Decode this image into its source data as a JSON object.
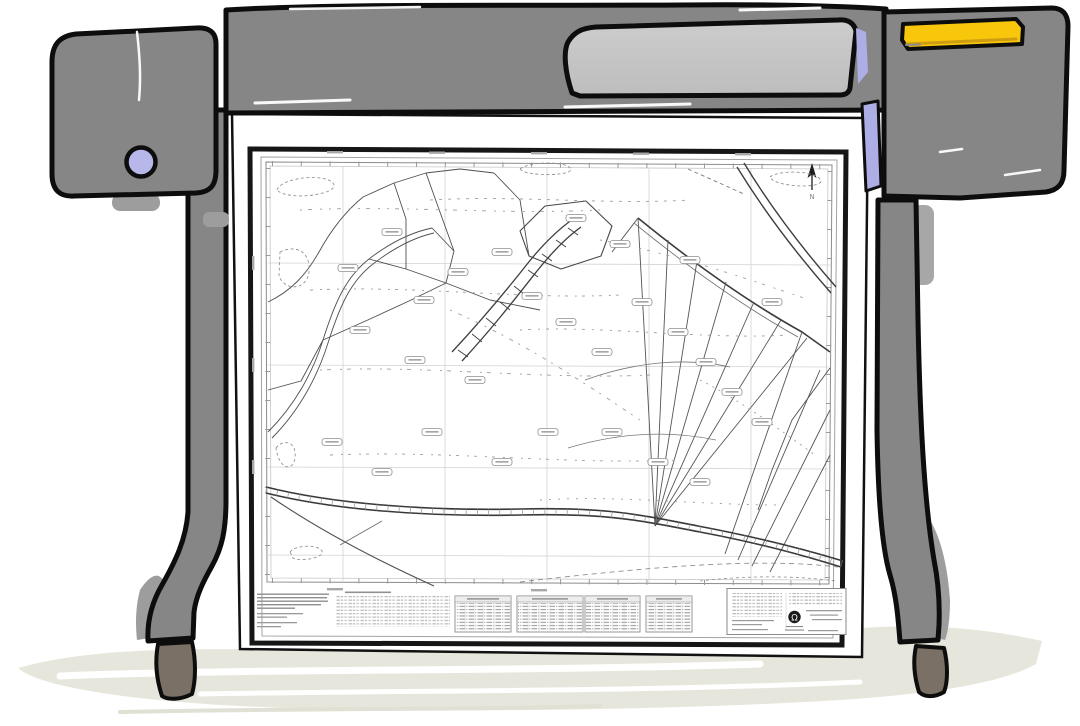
{
  "scene": {
    "background_color": "#ffffff"
  },
  "plotter": {
    "body_color": "#868686",
    "outline_color": "#0d0d0d",
    "window_color": "#c7c7c7",
    "knob_color": "#b7b7ea",
    "accent_lavender": "#aeaee6",
    "display_yellow": "#f8c60b",
    "display_yellow_shade": "#cf9d12",
    "caster_color": "#7a7065",
    "shadow_color": "#9d9d9d"
  },
  "floor": {
    "color": "#e6e6dc"
  },
  "map": {
    "north_label": "N",
    "paper_color": "#ffffff",
    "frame_color": "#161616",
    "inner_frame_color": "#9a9a9a",
    "grid_color": "#d2d2d2",
    "parcel_line_color": "#4f4f4f",
    "road_line_color": "#383838",
    "annotation_color": "#9a9a9a",
    "legend": {
      "table_count": 4
    },
    "title_block": {
      "logo_glyph": "Ω"
    }
  }
}
